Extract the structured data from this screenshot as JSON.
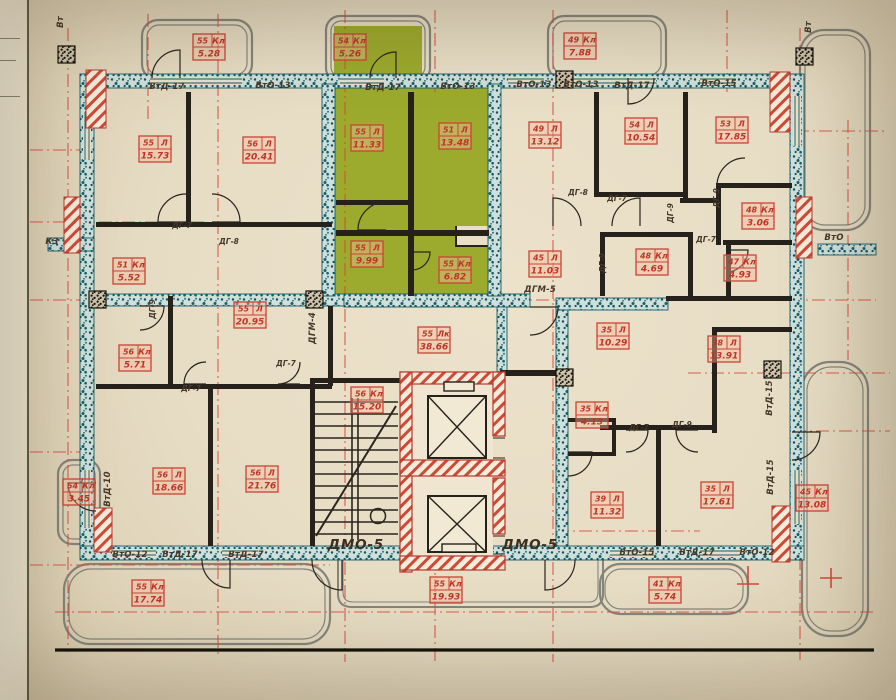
{
  "drawing": {
    "kind": "residential floor plan",
    "stair_core_note": "ДМО-5",
    "palette": {
      "paper": "#e7ddc5",
      "wall_teal": "#1a6a78",
      "wall_black": "#26211a",
      "accent_red": "#cb4335",
      "apartment_green": "#9cab2d",
      "annotation_brown": "#47392a"
    }
  },
  "room_labels": [
    {
      "num": "55",
      "type": "Кл",
      "area": "5.28",
      "x": 209,
      "y": 47
    },
    {
      "num": "54",
      "type": "Кл",
      "area": "5.26",
      "x": 350,
      "y": 47
    },
    {
      "num": "49",
      "type": "Кл",
      "area": "7.88",
      "x": 580,
      "y": 46
    },
    {
      "num": "55",
      "type": "Л",
      "area": "15.73",
      "x": 155,
      "y": 149
    },
    {
      "num": "56",
      "type": "Л",
      "area": "20.41",
      "x": 259,
      "y": 150
    },
    {
      "num": "55",
      "type": "Л",
      "area": "11.33",
      "x": 367,
      "y": 138
    },
    {
      "num": "51",
      "type": "Л",
      "area": "13.48",
      "x": 455,
      "y": 136
    },
    {
      "num": "49",
      "type": "Л",
      "area": "13.12",
      "x": 545,
      "y": 135
    },
    {
      "num": "54",
      "type": "Л",
      "area": "10.54",
      "x": 641,
      "y": 131
    },
    {
      "num": "53",
      "type": "Л",
      "area": "17.85",
      "x": 732,
      "y": 130
    },
    {
      "num": "51",
      "type": "Кл",
      "area": "5.52",
      "x": 129,
      "y": 271
    },
    {
      "num": "55",
      "type": "Л",
      "area": "9.99",
      "x": 367,
      "y": 254
    },
    {
      "num": "55",
      "type": "Кл",
      "area": "6.82",
      "x": 455,
      "y": 270
    },
    {
      "num": "45",
      "type": "Л",
      "area": "11.03",
      "x": 545,
      "y": 264
    },
    {
      "num": "48",
      "type": "Кл",
      "area": "3.06",
      "x": 758,
      "y": 216
    },
    {
      "num": "48",
      "type": "Кл",
      "area": "4.69",
      "x": 652,
      "y": 262
    },
    {
      "num": "47",
      "type": "Кл",
      "area": "4.93",
      "x": 740,
      "y": 268
    },
    {
      "num": "55",
      "type": "Л",
      "area": "20.95",
      "x": 250,
      "y": 315
    },
    {
      "num": "56",
      "type": "Кл",
      "area": "5.71",
      "x": 135,
      "y": 358
    },
    {
      "num": "55",
      "type": "Лк",
      "area": "38.66",
      "x": 434,
      "y": 340
    },
    {
      "num": "35",
      "type": "Л",
      "area": "10.29",
      "x": 613,
      "y": 336
    },
    {
      "num": "38",
      "type": "Л",
      "area": "13.91",
      "x": 724,
      "y": 349
    },
    {
      "num": "56",
      "type": "Кл",
      "area": "15.20",
      "x": 367,
      "y": 400
    },
    {
      "num": "35",
      "type": "Кл",
      "area": "4.13",
      "x": 592,
      "y": 415
    },
    {
      "num": "54",
      "type": "Кл",
      "area": "3.45",
      "x": 79,
      "y": 492
    },
    {
      "num": "56",
      "type": "Л",
      "area": "18.66",
      "x": 169,
      "y": 481
    },
    {
      "num": "56",
      "type": "Л",
      "area": "21.76",
      "x": 262,
      "y": 479
    },
    {
      "num": "39",
      "type": "Л",
      "area": "11.32",
      "x": 607,
      "y": 505
    },
    {
      "num": "35",
      "type": "Л",
      "area": "17.61",
      "x": 717,
      "y": 495
    },
    {
      "num": "45",
      "type": "Кл",
      "area": "13.08",
      "x": 812,
      "y": 498
    },
    {
      "num": "55",
      "type": "Кл",
      "area": "17.74",
      "x": 148,
      "y": 593
    },
    {
      "num": "55",
      "type": "Кл",
      "area": "19.93",
      "x": 446,
      "y": 590
    },
    {
      "num": "41",
      "type": "Кл",
      "area": "5.74",
      "x": 665,
      "y": 590
    }
  ],
  "wall_labels": [
    {
      "text": "ВтД-17",
      "x": 167,
      "y": 89,
      "rot": 0
    },
    {
      "text": "ВтО-13",
      "x": 273,
      "y": 88,
      "rot": 0
    },
    {
      "text": "ВтД-17",
      "x": 383,
      "y": 90,
      "rot": 0
    },
    {
      "text": "ВтО-13",
      "x": 458,
      "y": 89,
      "rot": 0
    },
    {
      "text": "ВтО-13",
      "x": 534,
      "y": 87,
      "rot": 0
    },
    {
      "text": "ВтО-13",
      "x": 581,
      "y": 87,
      "rot": 0
    },
    {
      "text": "ВтД-17",
      "x": 632,
      "y": 88,
      "rot": 0
    },
    {
      "text": "ВтО-15",
      "x": 719,
      "y": 86,
      "rot": 0
    },
    {
      "text": "ВтО-12",
      "x": 130,
      "y": 557,
      "rot": 0
    },
    {
      "text": "ВтД-17",
      "x": 180,
      "y": 557,
      "rot": 0
    },
    {
      "text": "ВтД-17",
      "x": 246,
      "y": 557,
      "rot": 0
    },
    {
      "text": "ВтО-15",
      "x": 637,
      "y": 555,
      "rot": 0
    },
    {
      "text": "ВтД-17",
      "x": 697,
      "y": 555,
      "rot": 0
    },
    {
      "text": "ВтО-12",
      "x": 757,
      "y": 555,
      "rot": 0
    },
    {
      "text": "ВтД-10",
      "x": 110,
      "y": 489,
      "rot": -90
    },
    {
      "text": "ВтД-15",
      "x": 773,
      "y": 477,
      "rot": -90
    },
    {
      "text": "ВтД-15",
      "x": 772,
      "y": 398,
      "rot": -90
    },
    {
      "text": "Вт",
      "x": 63,
      "y": 22,
      "rot": -90
    },
    {
      "text": "Вт",
      "x": 811,
      "y": 27,
      "rot": -90
    },
    {
      "text": "ВтО",
      "x": 834,
      "y": 240,
      "rot": 0
    },
    {
      "text": "К3",
      "x": 52,
      "y": 244,
      "rot": 0
    },
    {
      "text": "ДГМ-4",
      "x": 315,
      "y": 328,
      "rot": -90
    },
    {
      "text": "ДГМ-5",
      "x": 540,
      "y": 292,
      "rot": 0
    }
  ],
  "door_labels": [
    {
      "text": "ДГ-7",
      "x": 182,
      "y": 228,
      "rot": 0
    },
    {
      "text": "ДГ-8",
      "x": 229,
      "y": 244,
      "rot": 0
    },
    {
      "text": "ДГ-8",
      "x": 578,
      "y": 195,
      "rot": 0
    },
    {
      "text": "ДГ-7",
      "x": 617,
      "y": 201,
      "rot": 0
    },
    {
      "text": "ДГ-9",
      "x": 719,
      "y": 198,
      "rot": -90
    },
    {
      "text": "ДГ-9",
      "x": 673,
      "y": 213,
      "rot": -90
    },
    {
      "text": "ДГ-7",
      "x": 706,
      "y": 242,
      "rot": 0
    },
    {
      "text": "ДГ-9",
      "x": 605,
      "y": 263,
      "rot": -90
    },
    {
      "text": "ДГ-9",
      "x": 155,
      "y": 309,
      "rot": -90
    },
    {
      "text": "ДГ-7",
      "x": 191,
      "y": 391,
      "rot": 0
    },
    {
      "text": "ДГ-7",
      "x": 286,
      "y": 366,
      "rot": 0
    },
    {
      "text": "ДГ-7",
      "x": 639,
      "y": 430,
      "rot": 0
    },
    {
      "text": "ДГ-9",
      "x": 682,
      "y": 427,
      "rot": 0
    }
  ],
  "big_labels": [
    {
      "text": "ДМО-5",
      "x": 356,
      "y": 549
    },
    {
      "text": "ДМО-5",
      "x": 530,
      "y": 549
    }
  ]
}
